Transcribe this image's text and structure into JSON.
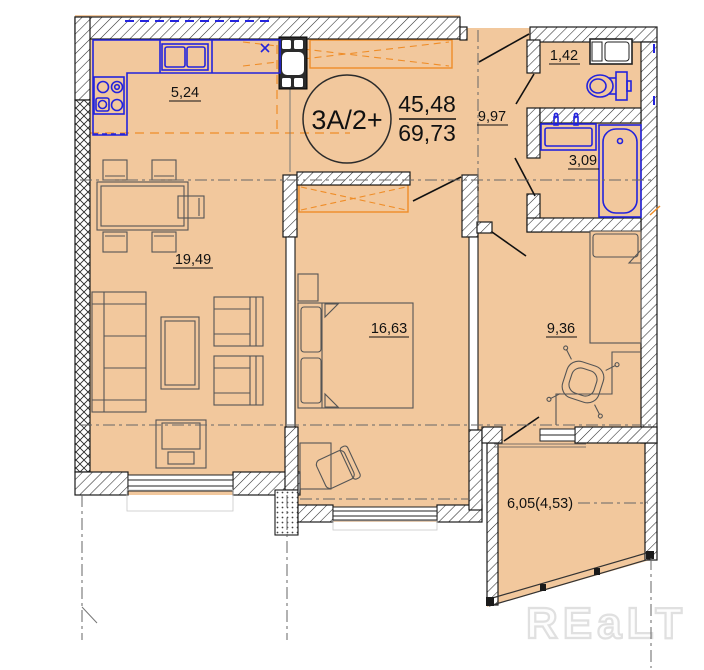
{
  "plan": {
    "type_label": "3A/2+",
    "area_living": "45,48",
    "area_total": "69,73"
  },
  "rooms": {
    "kitchen": {
      "area": "5,24"
    },
    "living_room": {
      "area": "19,49"
    },
    "bedroom_main": {
      "area": "16,63"
    },
    "hallway": {
      "area": "9,97"
    },
    "wc": {
      "area": "1,42"
    },
    "bathroom": {
      "area": "3,09"
    },
    "bedroom_second": {
      "area": "9,36"
    },
    "balcony": {
      "area": "6,05(4,53)"
    }
  },
  "kitchen": {
    "counter_mark": "x"
  },
  "watermark": "REaLT",
  "colors": {
    "floor": "#f2c89d",
    "fixtures_blue": "#2323dd",
    "wardrobe_orange": "#ef8d28"
  }
}
